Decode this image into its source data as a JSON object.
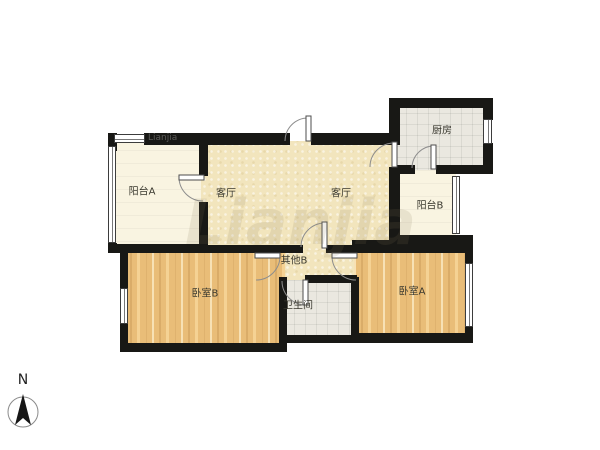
{
  "watermark": "Lianjia",
  "compass": {
    "label": "N"
  },
  "rooms": {
    "living_room": {
      "label": "客厅"
    },
    "balcony_a": {
      "label": "阳台A"
    },
    "balcony_b": {
      "label": "阳台B"
    },
    "kitchen": {
      "label": "厨房"
    },
    "bedroom_a": {
      "label": "卧室A"
    },
    "bedroom_b": {
      "label": "卧室B"
    },
    "bathroom": {
      "label": "卫生间"
    },
    "other_b": {
      "label": "其他B"
    }
  },
  "colors": {
    "wall": "#181815",
    "floor_living": "#f2e5bd",
    "floor_wood": "#e9bd78",
    "floor_tile": "#eae8e0",
    "floor_balcony": "#f9f4e1"
  }
}
